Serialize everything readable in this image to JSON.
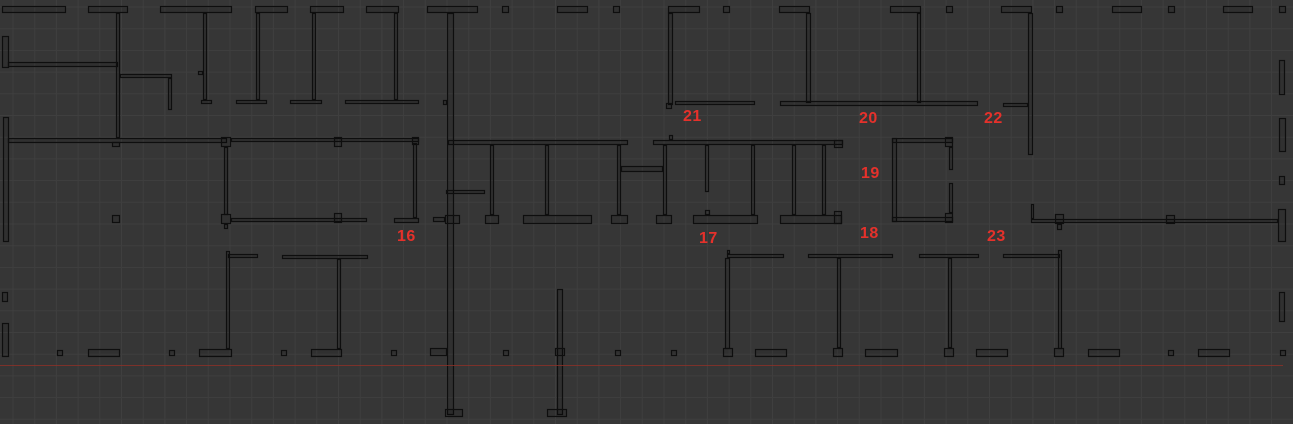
{
  "viewport": {
    "width": 1293,
    "height": 424,
    "background_color": "#363636",
    "grid": {
      "spacing": 21.7,
      "color": "#3f3f3f",
      "offset_x": 13,
      "offset_y": 7
    },
    "wall_color": "#0e0e0e",
    "wall_fill": "rgba(0,0,0,0.10)"
  },
  "reference_line": {
    "y": 365,
    "x1": 0,
    "x2": 1283,
    "color": "#8e3128"
  },
  "room_labels": {
    "color": "#e5312b",
    "font_size": 16,
    "items": [
      {
        "text": "16",
        "x": 397,
        "y": 230
      },
      {
        "text": "17",
        "x": 699,
        "y": 232
      },
      {
        "text": "18",
        "x": 860,
        "y": 227
      },
      {
        "text": "19",
        "x": 861,
        "y": 167
      },
      {
        "text": "20",
        "x": 859,
        "y": 112
      },
      {
        "text": "21",
        "x": 683,
        "y": 110
      },
      {
        "text": "22",
        "x": 984,
        "y": 112
      },
      {
        "text": "23",
        "x": 987,
        "y": 230
      }
    ]
  },
  "walls": [
    [
      2,
      6,
      64,
      7
    ],
    [
      88,
      6,
      40,
      7
    ],
    [
      160,
      6,
      72,
      7
    ],
    [
      255,
      6,
      33,
      7
    ],
    [
      310,
      6,
      34,
      7
    ],
    [
      366,
      6,
      33,
      7
    ],
    [
      427,
      6,
      51,
      7
    ],
    [
      502,
      6,
      7,
      7
    ],
    [
      557,
      6,
      31,
      7
    ],
    [
      613,
      6,
      7,
      7
    ],
    [
      668,
      6,
      32,
      7
    ],
    [
      723,
      6,
      7,
      7
    ],
    [
      779,
      6,
      31,
      7
    ],
    [
      890,
      6,
      31,
      7
    ],
    [
      946,
      6,
      7,
      7
    ],
    [
      1001,
      6,
      31,
      7
    ],
    [
      1056,
      6,
      7,
      7
    ],
    [
      1112,
      6,
      30,
      7
    ],
    [
      1168,
      6,
      7,
      7
    ],
    [
      1223,
      6,
      30,
      7
    ],
    [
      1279,
      6,
      7,
      7
    ],
    [
      2,
      36,
      7,
      32
    ],
    [
      8,
      62,
      110,
      5
    ],
    [
      116,
      13,
      4,
      125
    ],
    [
      120,
      74,
      52,
      4
    ],
    [
      168,
      78,
      4,
      32
    ],
    [
      198,
      71,
      5,
      4
    ],
    [
      203,
      13,
      4,
      87
    ],
    [
      201,
      100,
      11,
      4
    ],
    [
      256,
      13,
      4,
      87
    ],
    [
      236,
      100,
      31,
      4
    ],
    [
      312,
      13,
      4,
      87
    ],
    [
      290,
      100,
      32,
      4
    ],
    [
      394,
      13,
      4,
      87
    ],
    [
      345,
      100,
      74,
      4
    ],
    [
      447,
      13,
      7,
      402
    ],
    [
      443,
      100,
      4,
      5
    ],
    [
      433,
      217,
      12,
      5
    ],
    [
      430,
      348,
      17,
      8
    ],
    [
      445,
      409,
      18,
      8
    ],
    [
      668,
      13,
      5,
      92
    ],
    [
      675,
      101,
      80,
      4
    ],
    [
      666,
      103,
      6,
      6
    ],
    [
      806,
      13,
      5,
      90
    ],
    [
      780,
      101,
      198,
      5
    ],
    [
      917,
      13,
      4,
      90
    ],
    [
      1028,
      13,
      5,
      142
    ],
    [
      1003,
      103,
      25,
      4
    ],
    [
      3,
      117,
      6,
      125
    ],
    [
      8,
      138,
      219,
      5
    ],
    [
      112,
      142,
      8,
      5
    ],
    [
      221,
      137,
      10,
      10
    ],
    [
      231,
      138,
      188,
      4
    ],
    [
      334,
      137,
      8,
      10
    ],
    [
      412,
      137,
      7,
      8
    ],
    [
      413,
      143,
      4,
      75
    ],
    [
      394,
      218,
      25,
      5
    ],
    [
      224,
      147,
      4,
      68
    ],
    [
      221,
      214,
      10,
      10
    ],
    [
      224,
      224,
      4,
      5
    ],
    [
      231,
      218,
      136,
      4
    ],
    [
      334,
      213,
      8,
      10
    ],
    [
      112,
      215,
      8,
      8
    ],
    [
      448,
      140,
      180,
      5
    ],
    [
      653,
      140,
      190,
      5
    ],
    [
      834,
      140,
      9,
      8
    ],
    [
      669,
      135,
      4,
      5
    ],
    [
      446,
      190,
      39,
      4
    ],
    [
      490,
      145,
      4,
      70
    ],
    [
      545,
      145,
      4,
      70
    ],
    [
      617,
      145,
      4,
      70
    ],
    [
      663,
      145,
      4,
      70
    ],
    [
      705,
      145,
      4,
      47
    ],
    [
      705,
      210,
      5,
      5
    ],
    [
      751,
      145,
      4,
      70
    ],
    [
      792,
      145,
      4,
      70
    ],
    [
      822,
      145,
      4,
      70
    ],
    [
      621,
      166,
      42,
      6
    ],
    [
      445,
      215,
      15,
      9
    ],
    [
      485,
      215,
      14,
      9
    ],
    [
      523,
      215,
      69,
      9
    ],
    [
      611,
      215,
      17,
      9
    ],
    [
      656,
      215,
      16,
      9
    ],
    [
      693,
      215,
      65,
      9
    ],
    [
      780,
      215,
      62,
      9
    ],
    [
      834,
      211,
      8,
      13
    ],
    [
      892,
      138,
      5,
      84
    ],
    [
      892,
      138,
      61,
      5
    ],
    [
      892,
      217,
      61,
      5
    ],
    [
      945,
      137,
      8,
      10
    ],
    [
      945,
      213,
      8,
      10
    ],
    [
      949,
      147,
      4,
      23
    ],
    [
      949,
      183,
      4,
      30
    ],
    [
      1031,
      219,
      247,
      4
    ],
    [
      1031,
      204,
      3,
      15
    ],
    [
      1055,
      214,
      9,
      10
    ],
    [
      1057,
      224,
      5,
      6
    ],
    [
      1166,
      215,
      9,
      9
    ],
    [
      1278,
      209,
      8,
      33
    ],
    [
      1279,
      60,
      6,
      35
    ],
    [
      1279,
      118,
      7,
      34
    ],
    [
      1279,
      176,
      6,
      9
    ],
    [
      228,
      254,
      30,
      4
    ],
    [
      282,
      255,
      86,
      4
    ],
    [
      727,
      254,
      57,
      4
    ],
    [
      727,
      250,
      3,
      4
    ],
    [
      808,
      254,
      85,
      4
    ],
    [
      919,
      254,
      60,
      4
    ],
    [
      1003,
      254,
      57,
      4
    ],
    [
      226,
      251,
      4,
      98
    ],
    [
      337,
      259,
      4,
      90
    ],
    [
      725,
      258,
      5,
      91
    ],
    [
      837,
      258,
      4,
      90
    ],
    [
      948,
      258,
      4,
      90
    ],
    [
      1058,
      250,
      4,
      99
    ],
    [
      557,
      289,
      6,
      126
    ],
    [
      555,
      348,
      10,
      8
    ],
    [
      547,
      409,
      20,
      8
    ],
    [
      57,
      350,
      6,
      6
    ],
    [
      169,
      350,
      6,
      6
    ],
    [
      281,
      350,
      6,
      6
    ],
    [
      391,
      350,
      6,
      6
    ],
    [
      503,
      350,
      6,
      6
    ],
    [
      615,
      350,
      6,
      6
    ],
    [
      671,
      350,
      6,
      6
    ],
    [
      1168,
      350,
      6,
      6
    ],
    [
      1280,
      350,
      6,
      6
    ],
    [
      88,
      349,
      32,
      8
    ],
    [
      199,
      349,
      33,
      8
    ],
    [
      311,
      349,
      31,
      8
    ],
    [
      755,
      349,
      32,
      8
    ],
    [
      865,
      349,
      33,
      8
    ],
    [
      976,
      349,
      32,
      8
    ],
    [
      1088,
      349,
      32,
      8
    ],
    [
      1198,
      349,
      32,
      8
    ],
    [
      723,
      348,
      10,
      9
    ],
    [
      833,
      348,
      10,
      9
    ],
    [
      944,
      348,
      10,
      9
    ],
    [
      1054,
      348,
      10,
      9
    ],
    [
      2,
      292,
      6,
      10
    ],
    [
      2,
      323,
      7,
      34
    ],
    [
      1279,
      292,
      6,
      30
    ]
  ]
}
